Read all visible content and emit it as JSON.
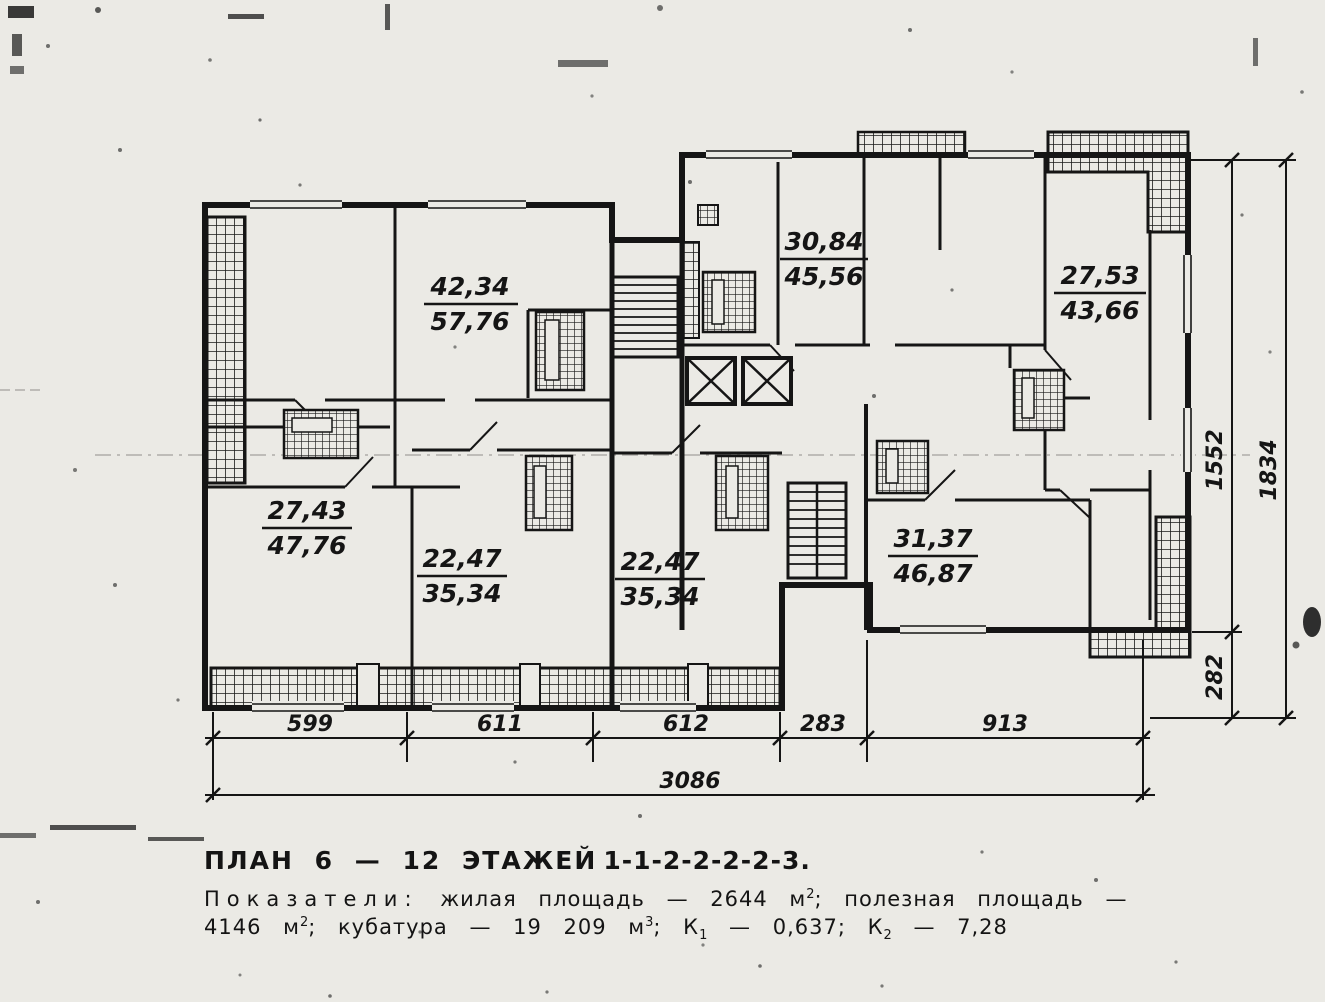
{
  "apartments": [
    {
      "living": "42,34",
      "total": "57,76"
    },
    {
      "living": "30,84",
      "total": "45,56"
    },
    {
      "living": "27,53",
      "total": "43,66"
    },
    {
      "living": "27,43",
      "total": "47,76"
    },
    {
      "living": "22,47",
      "total": "35,34"
    },
    {
      "living": "22,47",
      "total": "35,34"
    },
    {
      "living": "31,37",
      "total": "46,87"
    }
  ],
  "dimensions": {
    "bottom_segments": [
      "599",
      "611",
      "612",
      "283",
      "913"
    ],
    "bottom_total": "3086",
    "right_upper": "1552",
    "right_lower": "282",
    "right_total": "1834"
  },
  "caption": {
    "title_a": "ПЛАН 6 — 12 ЭТАЖЕЙ",
    "title_code": "1-1-2-2-2-2-3.",
    "ind1_label": "Показатели:",
    "ind1_a": " жилая площадь — 2644 м",
    "ind1_sup": "2",
    "ind1_b": "; полезная площадь —",
    "ind2_a": "4146 м",
    "ind2_sup1": "2",
    "ind2_b": "; кубатура — 19 209 м",
    "ind2_sup2": "3",
    "ind2_c": "; К",
    "ind2_sub1": "1",
    "ind2_d": " — 0,637; К",
    "ind2_sub2": "2",
    "ind2_e": " — 7,28"
  },
  "colors": {
    "ink": "#151515",
    "paper": "#ebeae5"
  }
}
